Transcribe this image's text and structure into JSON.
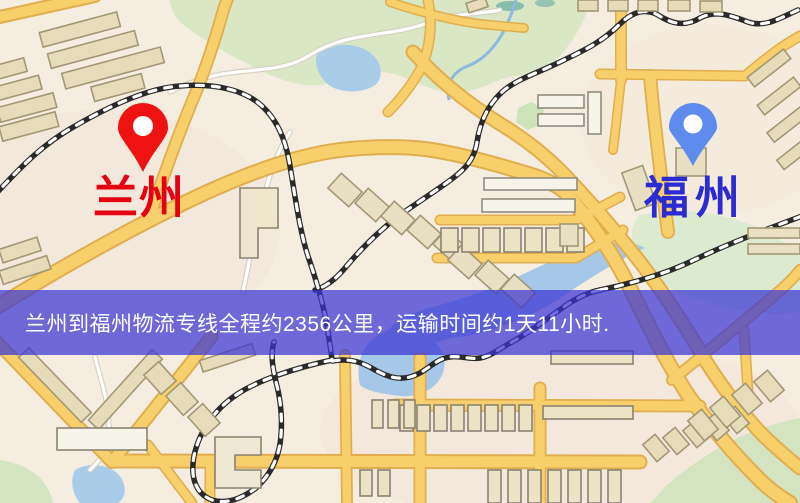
{
  "map": {
    "kind": "logistics-route-map",
    "origin": {
      "name": "兰州",
      "label_color": "#e60111",
      "pin_color": "#ee1310"
    },
    "destination": {
      "name": "福州",
      "label_color": "#2b2bd3",
      "pin_color": "#5d8cee"
    },
    "banner": {
      "text": "兰州到福州物流专线全程约2356公里，运输时间约1天11小时.",
      "background": "#3a35d4",
      "opacity": 0.72,
      "text_color": "#ffffff"
    },
    "route": {
      "distance_km": "2356",
      "duration": "1天11小时"
    },
    "colors": {
      "land": "#f5eee0",
      "park": "#d9e7c4",
      "water": "#a5c8e8",
      "road_major_fill": "#f7cf6b",
      "road_casing": "#e0ae4e",
      "railway": "#2a2a2a",
      "building_fill": "#e7dcba",
      "building_stroke": "#a39874"
    }
  }
}
